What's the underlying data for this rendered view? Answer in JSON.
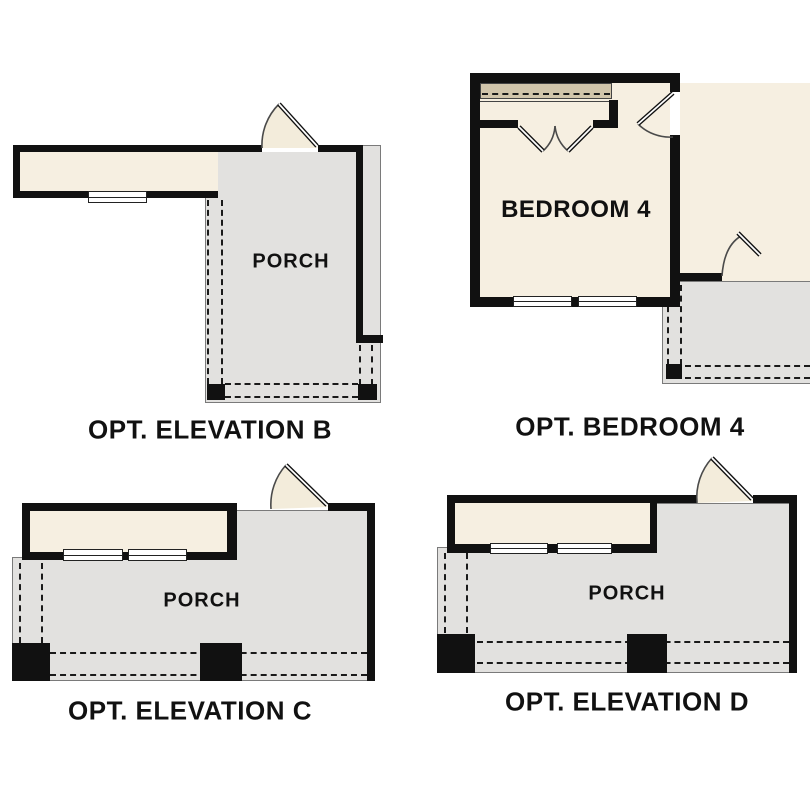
{
  "sheet": {
    "background": "#ffffff"
  },
  "colors": {
    "sheet": "#ffffff",
    "wall": "#111111",
    "interior": "#f6efe1",
    "porch": "#e2e1df",
    "porch_outline": "#7a7a7a",
    "closet_shelf": "#d1c5ab",
    "door_fill": "#f3ecdb",
    "door_arc": "#4a4a4a",
    "dash": "#1a1a1a",
    "window_frame": "#222222",
    "label": "#111111"
  },
  "plans": {
    "elevation_b": {
      "room_label": "PORCH",
      "caption": "OPT. ELEVATION B"
    },
    "bedroom_4": {
      "room_label": "BEDROOM 4",
      "caption": "OPT. BEDROOM 4"
    },
    "elevation_c": {
      "room_label": "PORCH",
      "caption": "OPT. ELEVATION C"
    },
    "elevation_d": {
      "room_label": "PORCH",
      "caption": "OPT. ELEVATION D"
    }
  }
}
